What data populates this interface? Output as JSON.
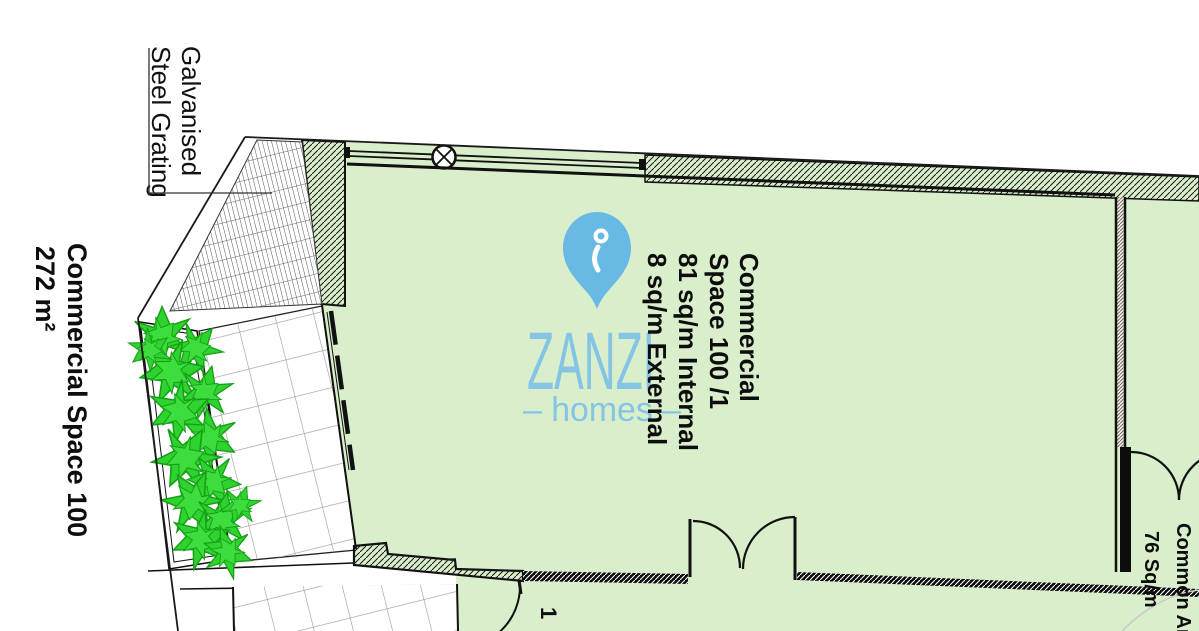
{
  "labels": {
    "grating_note": {
      "line1": "Galvanised",
      "line2": "Steel Grating"
    },
    "property_title": {
      "line1": "Commercial Space 100",
      "line2": "272 m²"
    },
    "unit_info": {
      "line1": "Commercial",
      "line2": "Space 100 /1",
      "line3": "81 sq/m Internal",
      "line4": "8 sq/m External"
    },
    "common_area": {
      "line1": "Common Area",
      "line2": "76 Sq/m"
    },
    "door_mark": "1"
  },
  "logo": {
    "brand": "ZANZI",
    "tagline": "– homes –"
  },
  "colors": {
    "floor_fill": "#d9eecb",
    "plant_green": "#2fd32f",
    "brand_blue": "#82c3e3",
    "line_black": "#111111",
    "tile_gray": "#999999"
  }
}
